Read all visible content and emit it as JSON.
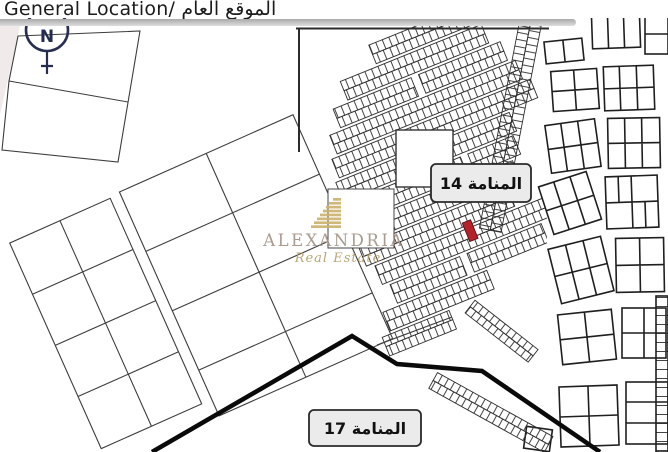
{
  "header": {
    "title": "General Location/ الموقع العام"
  },
  "compass": {
    "north_letter": "N"
  },
  "watermark": {
    "brand": "ALEXANDRIA",
    "tagline": "Real Estate"
  },
  "map": {
    "district_labels": [
      {
        "id": "manama-14",
        "label": "المنامة 14"
      },
      {
        "id": "manama-17",
        "label": "المنامة 17"
      }
    ]
  },
  "colors": {
    "highlight": "#b5232a",
    "boundary": "#0a0a0a",
    "map_line": "#3d3d3d",
    "block_line": "#1f1f1f",
    "compass": "#272e4f",
    "label_bg": "#ebebeb",
    "watermark_gold": "#cdb36f",
    "watermark_text": "#a29386",
    "watermark_tagline": "#b2a06d"
  }
}
